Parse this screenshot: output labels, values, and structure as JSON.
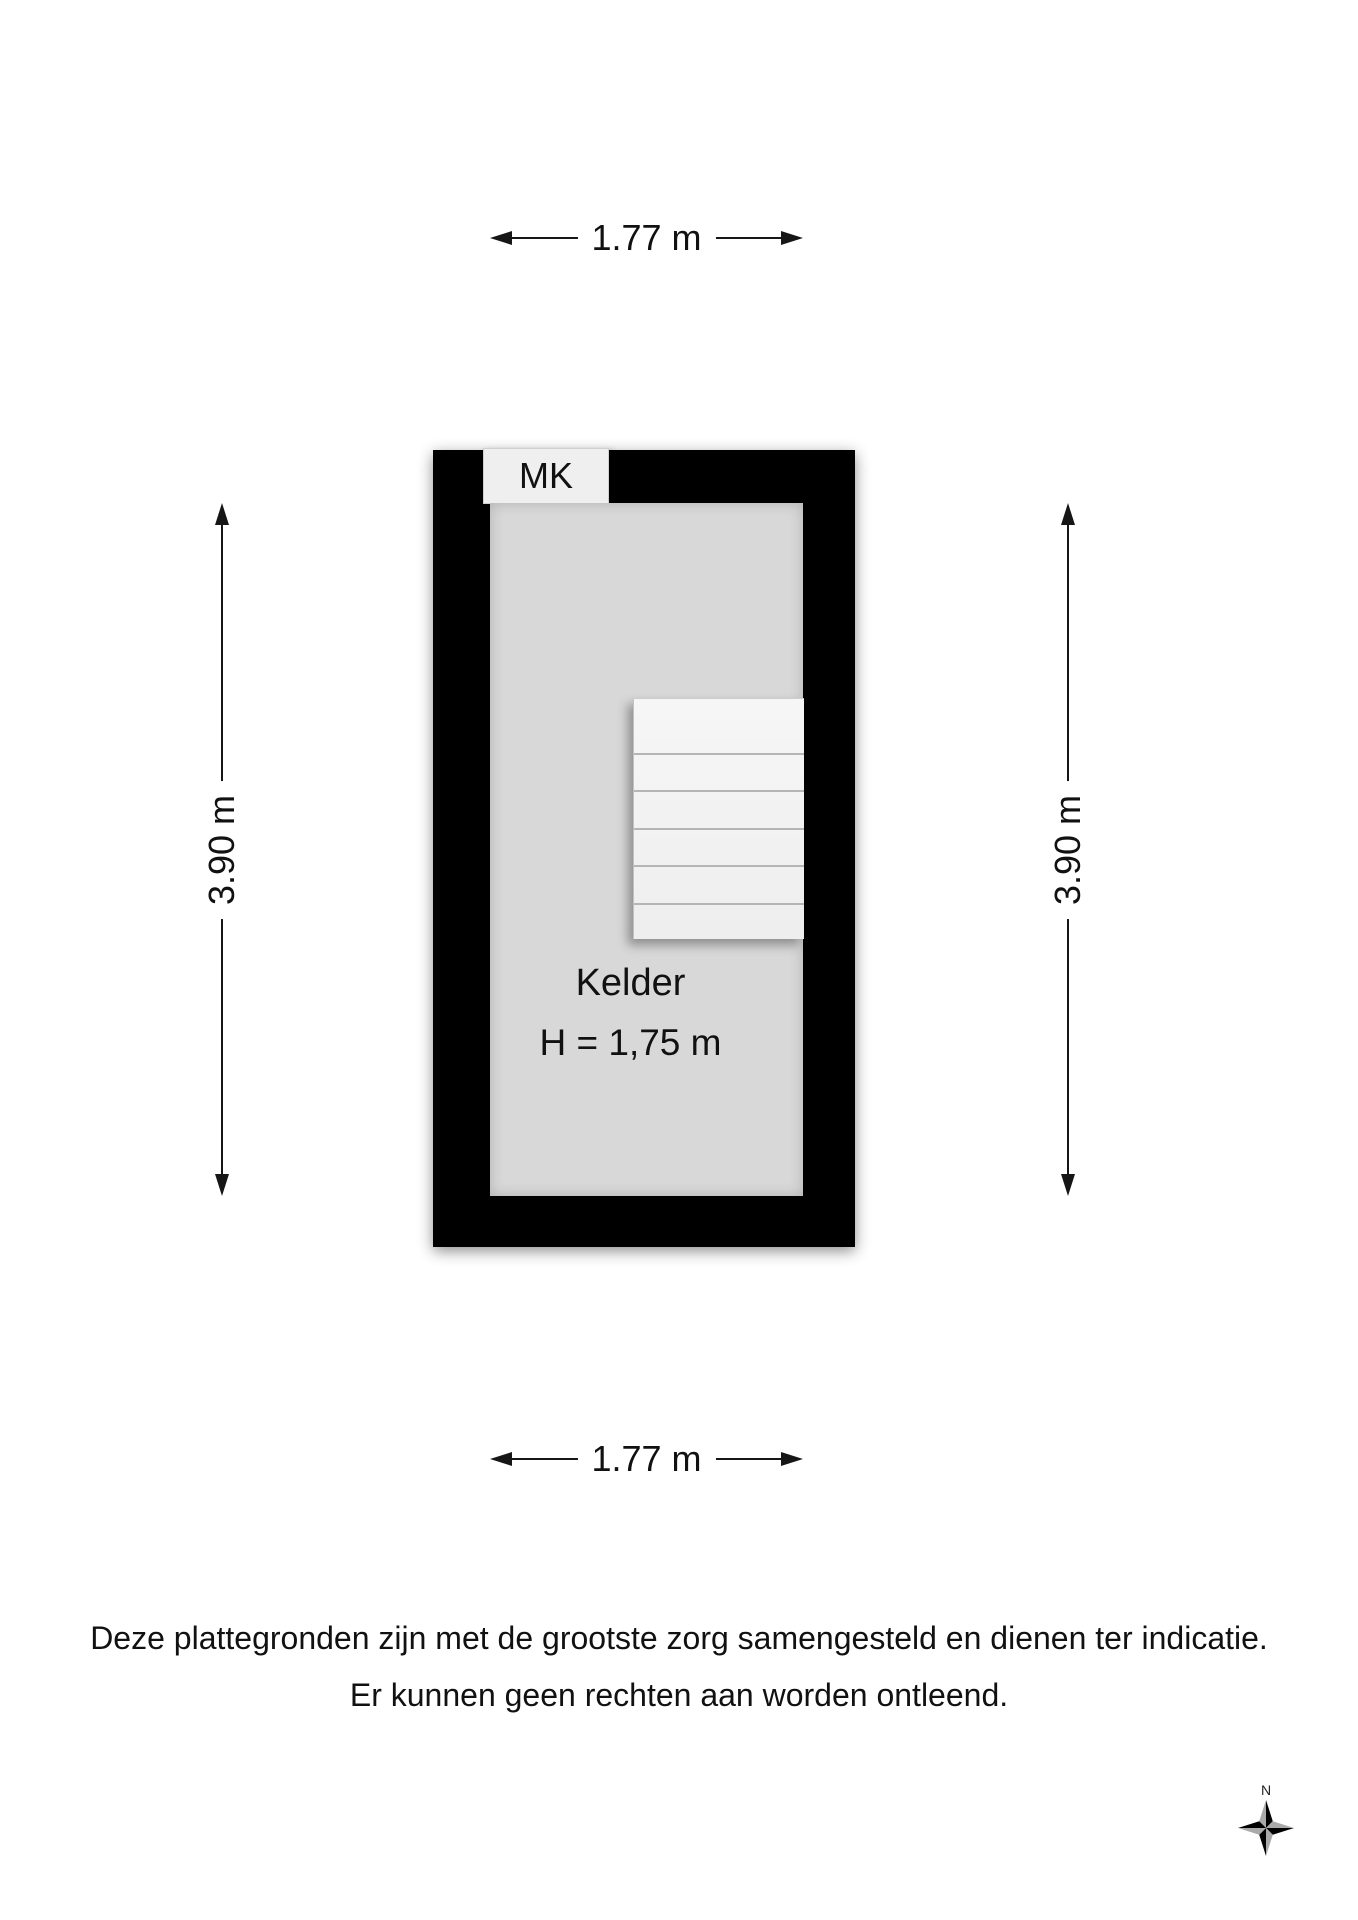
{
  "floorplan": {
    "room_label": "Kelder",
    "room_height_label": "H = 1,75 m",
    "mk_label": "MK",
    "dimensions": {
      "top": "1.77 m",
      "bottom": "1.77 m",
      "left": "3.90 m",
      "right": "3.90 m"
    }
  },
  "disclaimer": {
    "line1": "Deze plattegronden zijn met de grootste zorg samengesteld en dienen ter indicatie.",
    "line2": "Er kunnen geen rechten aan worden ontleend."
  },
  "compass": {
    "north_label": "N"
  },
  "colors": {
    "wall": "#000000",
    "floor": "#d8d8d8",
    "stairs": "#f3f3f3",
    "mk_background": "#efefef",
    "background": "#ffffff",
    "compass_dark": "#000000",
    "compass_light": "#a9a9a9"
  }
}
